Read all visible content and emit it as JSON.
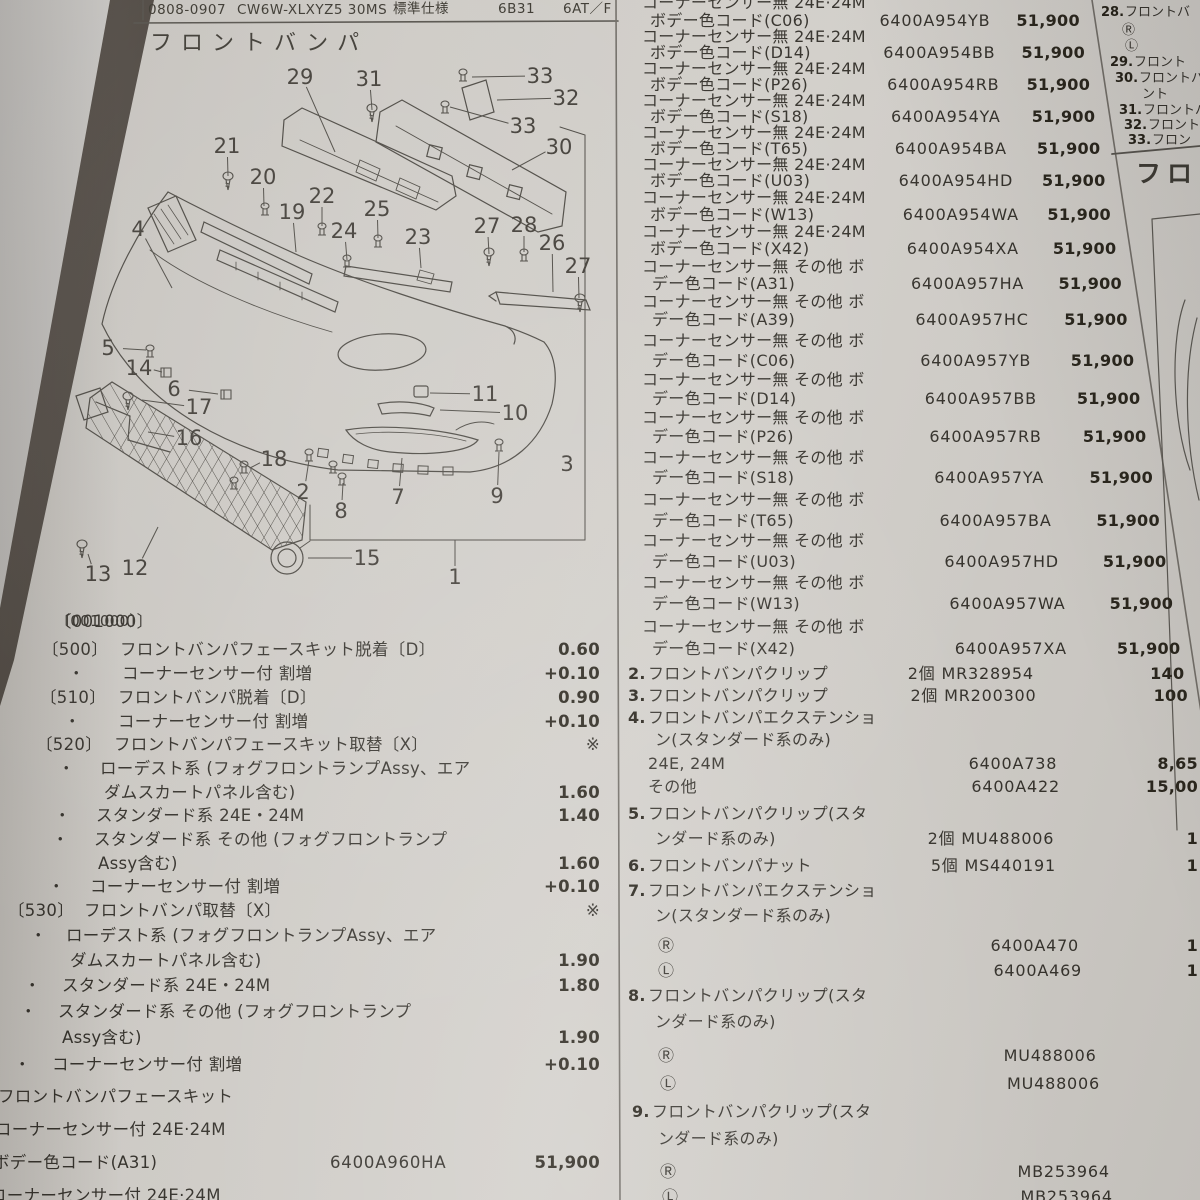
{
  "header": {
    "date_code": "0808-0907",
    "model": "CW6W-XLXYZ5 30MS",
    "spec": "標準仕様",
    "engine": "6B31",
    "trans": "6AT／F"
  },
  "section": {
    "title": "フロントバンパ",
    "op_code": "〔001000〕"
  },
  "diagram": {
    "callouts": [
      {
        "n": "29",
        "x": 300,
        "y": 77,
        "tx": 335,
        "ty": 152
      },
      {
        "n": "31",
        "x": 369,
        "y": 79,
        "tx": 372,
        "ty": 110
      },
      {
        "n": "33",
        "x": 540,
        "y": 76,
        "tx": 472,
        "ty": 77
      },
      {
        "n": "32",
        "x": 566,
        "y": 98,
        "tx": 497,
        "ty": 100
      },
      {
        "n": "33",
        "x": 523,
        "y": 126,
        "tx": 450,
        "ty": 107
      },
      {
        "n": "30",
        "x": 559,
        "y": 147,
        "tx": 512,
        "ty": 170
      },
      {
        "n": "21",
        "x": 227,
        "y": 146,
        "tx": 228,
        "ty": 176
      },
      {
        "n": "20",
        "x": 263,
        "y": 177,
        "tx": 264,
        "ty": 206
      },
      {
        "n": "22",
        "x": 322,
        "y": 196,
        "tx": 322,
        "ty": 226
      },
      {
        "n": "19",
        "x": 292,
        "y": 212,
        "tx": 296,
        "ty": 252
      },
      {
        "n": "24",
        "x": 344,
        "y": 231,
        "tx": 347,
        "ty": 260
      },
      {
        "n": "25",
        "x": 377,
        "y": 209,
        "tx": 378,
        "ty": 238
      },
      {
        "n": "23",
        "x": 418,
        "y": 237,
        "tx": 421,
        "ty": 268
      },
      {
        "n": "27",
        "x": 487,
        "y": 226,
        "tx": 489,
        "ty": 254
      },
      {
        "n": "28",
        "x": 524,
        "y": 225,
        "tx": 524,
        "ty": 252
      },
      {
        "n": "26",
        "x": 552,
        "y": 243,
        "tx": 553,
        "ty": 292
      },
      {
        "n": "27",
        "x": 578,
        "y": 266,
        "tx": 579,
        "ty": 298
      },
      {
        "n": "4",
        "x": 138,
        "y": 229,
        "tx": 172,
        "ty": 288
      },
      {
        "n": "5",
        "x": 108,
        "y": 348,
        "tx": 146,
        "ty": 350
      },
      {
        "n": "14",
        "x": 139,
        "y": 368,
        "tx": 162,
        "ty": 372
      },
      {
        "n": "6",
        "x": 174,
        "y": 389,
        "tx": 218,
        "ty": 394
      },
      {
        "n": "17",
        "x": 199,
        "y": 407,
        "tx": 142,
        "ty": 400
      },
      {
        "n": "16",
        "x": 189,
        "y": 438,
        "tx": 148,
        "ty": 432
      },
      {
        "n": "18",
        "x": 274,
        "y": 459,
        "tx": 250,
        "ty": 468
      },
      {
        "n": "2",
        "x": 303,
        "y": 492,
        "tx": 309,
        "ty": 460
      },
      {
        "n": "8",
        "x": 341,
        "y": 511,
        "tx": 343,
        "ty": 483
      },
      {
        "n": "7",
        "x": 398,
        "y": 497,
        "tx": 402,
        "ty": 458
      },
      {
        "n": "9",
        "x": 497,
        "y": 496,
        "tx": 499,
        "ty": 452
      },
      {
        "n": "3",
        "x": 567,
        "y": 464
      },
      {
        "n": "15",
        "x": 367,
        "y": 558,
        "tx": 308,
        "ty": 558
      },
      {
        "n": "1",
        "x": 455,
        "y": 577,
        "tx": 455,
        "ty": 543
      },
      {
        "n": "10",
        "x": 515,
        "y": 413,
        "tx": 440,
        "ty": 410
      },
      {
        "n": "11",
        "x": 485,
        "y": 394,
        "tx": 430,
        "ty": 393
      },
      {
        "n": "13",
        "x": 98,
        "y": 574,
        "tx": 88,
        "ty": 554
      },
      {
        "n": "12",
        "x": 135,
        "y": 568,
        "tx": 158,
        "ty": 527
      }
    ]
  },
  "labor": {
    "rows": [
      {
        "y": 613,
        "label": "〔001000〕",
        "lx": 55
      },
      {
        "y": 641,
        "label": "〔500〕",
        "lx": 42,
        "text": "フロントバンパフェースキット脱着〔D〕",
        "tx": 120,
        "val": "0.60"
      },
      {
        "y": 665,
        "label": "・",
        "lx": 68,
        "text": "コーナーセンサー付 割増",
        "tx": 122,
        "val": "+0.10"
      },
      {
        "y": 689,
        "label": "〔510〕",
        "lx": 40,
        "text": "フロントバンパ脱着〔D〕",
        "tx": 118,
        "val": "0.90"
      },
      {
        "y": 713,
        "label": "・",
        "lx": 64,
        "text": "コーナーセンサー付 割増",
        "tx": 118,
        "val": "+0.10"
      },
      {
        "y": 736,
        "label": "〔520〕",
        "lx": 36,
        "text": "フロントバンパフェースキット取替〔X〕",
        "tx": 114,
        "val": "※"
      },
      {
        "y": 760,
        "label": "・",
        "lx": 58,
        "text": "ローデスト系 (フォグフロントランプAssy、エア",
        "tx": 100
      },
      {
        "y": 784,
        "text": "ダムスカートパネル含む)",
        "tx": 104,
        "val": "1.60"
      },
      {
        "y": 807,
        "label": "・",
        "lx": 54,
        "text": "スタンダード系 24E・24M",
        "tx": 96,
        "val": "1.40"
      },
      {
        "y": 831,
        "label": "・",
        "lx": 52,
        "text": "スタンダード系 その他 (フォグフロントランプ",
        "tx": 94
      },
      {
        "y": 855,
        "text": "Assy含む)",
        "tx": 98,
        "val": "1.60"
      },
      {
        "y": 878,
        "label": "・",
        "lx": 48,
        "text": "コーナーセンサー付 割増",
        "tx": 90,
        "val": "+0.10"
      },
      {
        "y": 902,
        "label": "〔530〕",
        "lx": 8,
        "text": "フロントバンパ取替〔X〕",
        "tx": 84,
        "val": "※"
      },
      {
        "y": 927,
        "label": "・",
        "lx": 30,
        "text": "ローデスト系 (フォグフロントランプAssy、エア",
        "tx": 66
      },
      {
        "y": 952,
        "text": "ダムスカートパネル含む)",
        "tx": 70,
        "val": "1.90"
      },
      {
        "y": 977,
        "label": "・",
        "lx": 24,
        "text": "スタンダード系 24E・24M",
        "tx": 62,
        "val": "1.80"
      },
      {
        "y": 1003,
        "label": "・",
        "lx": 20,
        "text": "スタンダード系 その他 (フォグフロントランプ",
        "tx": 58
      },
      {
        "y": 1029,
        "text": "Assy含む)",
        "tx": 62,
        "val": "1.90"
      },
      {
        "y": 1056,
        "label": "・",
        "lx": 14,
        "text": "コーナーセンサー付 割増",
        "tx": 52,
        "val": "+0.10"
      }
    ]
  },
  "left_parts": {
    "rows": [
      {
        "y": 1088,
        "x": -2,
        "t": "フロントバンパフェースキット"
      },
      {
        "y": 1121,
        "x": -5,
        "t": "コーナーセンサー付 24E·24M"
      },
      {
        "y": 1154,
        "x": -7,
        "t": "ボデー色コード(A31)",
        "p": "6400A960HA",
        "pr": "51,900"
      },
      {
        "y": 1187,
        "x": -10,
        "t": "コーナーセンサー付 24E·24M"
      }
    ]
  },
  "middle": {
    "rows": [
      {
        "y": -6,
        "x": 642,
        "t": "コーナーセンサー無 24E·24M"
      },
      {
        "y": 12,
        "x": 650,
        "t": "ボデー色コード(C06)",
        "p": "6400A954YB",
        "pr": "51,900"
      },
      {
        "y": 28,
        "x": 642,
        "t": "コーナーセンサー無 24E·24M"
      },
      {
        "y": 44,
        "x": 650,
        "t": "ボデー色コード(D14)",
        "p": "6400A954BB",
        "pr": "51,900"
      },
      {
        "y": 60,
        "x": 642,
        "t": "コーナーセンサー無 24E·24M"
      },
      {
        "y": 76,
        "x": 650,
        "t": "ボデー色コード(P26)",
        "p": "6400A954RB",
        "pr": "51,900"
      },
      {
        "y": 92,
        "x": 642,
        "t": "コーナーセンサー無 24E·24M"
      },
      {
        "y": 108,
        "x": 650,
        "t": "ボデー色コード(S18)",
        "p": "6400A954YA",
        "pr": "51,900"
      },
      {
        "y": 124,
        "x": 642,
        "t": "コーナーセンサー無 24E·24M"
      },
      {
        "y": 140,
        "x": 650,
        "t": "ボデー色コード(T65)",
        "p": "6400A954BA",
        "pr": "51,900"
      },
      {
        "y": 156,
        "x": 642,
        "t": "コーナーセンサー無 24E·24M"
      },
      {
        "y": 172,
        "x": 650,
        "t": "ボデー色コード(U03)",
        "p": "6400A954HD",
        "pr": "51,900"
      },
      {
        "y": 189,
        "x": 642,
        "t": "コーナーセンサー無 24E·24M"
      },
      {
        "y": 206,
        "x": 650,
        "t": "ボデー色コード(W13)",
        "p": "6400A954WA",
        "pr": "51,900"
      },
      {
        "y": 223,
        "x": 642,
        "t": "コーナーセンサー無 24E·24M"
      },
      {
        "y": 240,
        "x": 650,
        "t": "ボデー色コード(X42)",
        "p": "6400A954XA",
        "pr": "51,900"
      },
      {
        "y": 258,
        "x": 642,
        "t": "コーナーセンサー無 その他 ボ"
      },
      {
        "y": 275,
        "x": 652,
        "t": "デー色コード(A31)",
        "p": "6400A957HA",
        "pr": "51,900"
      },
      {
        "y": 293,
        "x": 642,
        "t": "コーナーセンサー無 その他 ボ"
      },
      {
        "y": 311,
        "x": 652,
        "t": "デー色コード(A39)",
        "p": "6400A957HC",
        "pr": "51,900"
      },
      {
        "y": 332,
        "x": 642,
        "t": "コーナーセンサー無 その他 ボ"
      },
      {
        "y": 352,
        "x": 652,
        "t": "デー色コード(C06)",
        "p": "6400A957YB",
        "pr": "51,900"
      },
      {
        "y": 371,
        "x": 642,
        "t": "コーナーセンサー無 その他 ボ"
      },
      {
        "y": 390,
        "x": 652,
        "t": "デー色コード(D14)",
        "p": "6400A957BB",
        "pr": "51,900"
      },
      {
        "y": 409,
        "x": 642,
        "t": "コーナーセンサー無 その他 ボ"
      },
      {
        "y": 428,
        "x": 652,
        "t": "デー色コード(P26)",
        "p": "6400A957RB",
        "pr": "51,900"
      },
      {
        "y": 449,
        "x": 642,
        "t": "コーナーセンサー無 その他 ボ"
      },
      {
        "y": 469,
        "x": 652,
        "t": "デー色コード(S18)",
        "p": "6400A957YA",
        "pr": "51,900"
      },
      {
        "y": 491,
        "x": 642,
        "t": "コーナーセンサー無 その他 ボ"
      },
      {
        "y": 512,
        "x": 652,
        "t": "デー色コード(T65)",
        "p": "6400A957BA",
        "pr": "51,900"
      },
      {
        "y": 532,
        "x": 642,
        "t": "コーナーセンサー無 その他 ボ"
      },
      {
        "y": 553,
        "x": 652,
        "t": "デー色コード(U03)",
        "p": "6400A957HD",
        "pr": "51,900"
      },
      {
        "y": 574,
        "x": 642,
        "t": "コーナーセンサー無 その他 ボ"
      },
      {
        "y": 595,
        "x": 652,
        "t": "デー色コード(W13)",
        "p": "6400A957WA",
        "pr": "51,900"
      },
      {
        "y": 618,
        "x": 642,
        "t": "コーナーセンサー無 その他 ボ"
      },
      {
        "y": 640,
        "x": 652,
        "t": "デー色コード(X42)",
        "p": "6400A957XA",
        "pr": "51,900"
      },
      {
        "y": 665,
        "x": 628,
        "n": "2.",
        "t": "フロントバンパクリップ",
        "q": "2個",
        "p": "MR328954",
        "pr": "140"
      },
      {
        "y": 687,
        "x": 628,
        "n": "3.",
        "t": "フロントバンパクリップ",
        "q": "2個",
        "p": "MR200300",
        "pr": "100"
      },
      {
        "y": 709,
        "x": 628,
        "n": "4.",
        "t": "フロントバンパエクステンショ"
      },
      {
        "y": 731,
        "x": 655,
        "t": "ン(スタンダード系のみ)"
      },
      {
        "y": 755,
        "x": 648,
        "t": "24E, 24M",
        "p": "6400A738",
        "pr": "8,65"
      },
      {
        "y": 778,
        "x": 648,
        "t": "その他",
        "p": "6400A422",
        "pr": "15,00"
      },
      {
        "y": 805,
        "x": 628,
        "n": "5.",
        "t": "フロントバンパクリップ(スタ"
      },
      {
        "y": 830,
        "x": 655,
        "t": "ンダード系のみ)",
        "q": "2個",
        "p": "MU488006",
        "pr": "1"
      },
      {
        "y": 857,
        "x": 628,
        "n": "6.",
        "t": "フロントバンパナット",
        "q": "5個",
        "p": "MS440191",
        "pr": "1"
      },
      {
        "y": 882,
        "x": 628,
        "n": "7.",
        "t": "フロントバンパエクステンショ"
      },
      {
        "y": 907,
        "x": 655,
        "t": "ン(スタンダード系のみ)"
      },
      {
        "y": 937,
        "x": 658,
        "t": "Ⓡ",
        "p": "6400A470",
        "pr": "1"
      },
      {
        "y": 962,
        "x": 658,
        "t": "Ⓛ",
        "p": "6400A469",
        "pr": "1"
      },
      {
        "y": 987,
        "x": 628,
        "n": "8.",
        "t": "フロントバンパクリップ(スタ"
      },
      {
        "y": 1013,
        "x": 655,
        "t": "ンダード系のみ)"
      },
      {
        "y": 1047,
        "x": 658,
        "t": "Ⓡ",
        "p": "MU488006"
      },
      {
        "y": 1075,
        "x": 660,
        "t": "Ⓛ",
        "p": "MU488006"
      },
      {
        "y": 1103,
        "x": 632,
        "n": "9.",
        "t": "フロントバンパクリップ(スタ"
      },
      {
        "y": 1130,
        "x": 658,
        "t": "ンダード系のみ)"
      },
      {
        "y": 1163,
        "x": 660,
        "t": "Ⓡ",
        "p": "MB253964"
      },
      {
        "y": 1188,
        "x": 662,
        "t": "Ⓛ",
        "p": "MB253964"
      }
    ]
  },
  "right_col": {
    "items": [
      {
        "x": 1101,
        "y": 6,
        "n": "28.",
        "t": "フロントバ"
      },
      {
        "x": 1122,
        "y": 24,
        "t": "Ⓡ"
      },
      {
        "x": 1125,
        "y": 40,
        "t": "Ⓛ"
      },
      {
        "x": 1110,
        "y": 56,
        "n": "29.",
        "t": "フロント"
      },
      {
        "x": 1115,
        "y": 72,
        "n": "30.",
        "t": "フロントバ"
      },
      {
        "x": 1142,
        "y": 88,
        "t": "ント"
      },
      {
        "x": 1119,
        "y": 104,
        "n": "31.",
        "t": "フロントバ"
      },
      {
        "x": 1124,
        "y": 119,
        "n": "32.",
        "t": "フロント"
      },
      {
        "x": 1128,
        "y": 134,
        "n": "33.",
        "t": "フロン"
      },
      {
        "x": 1136,
        "y": 163,
        "t": "フロン",
        "title": true
      }
    ]
  }
}
